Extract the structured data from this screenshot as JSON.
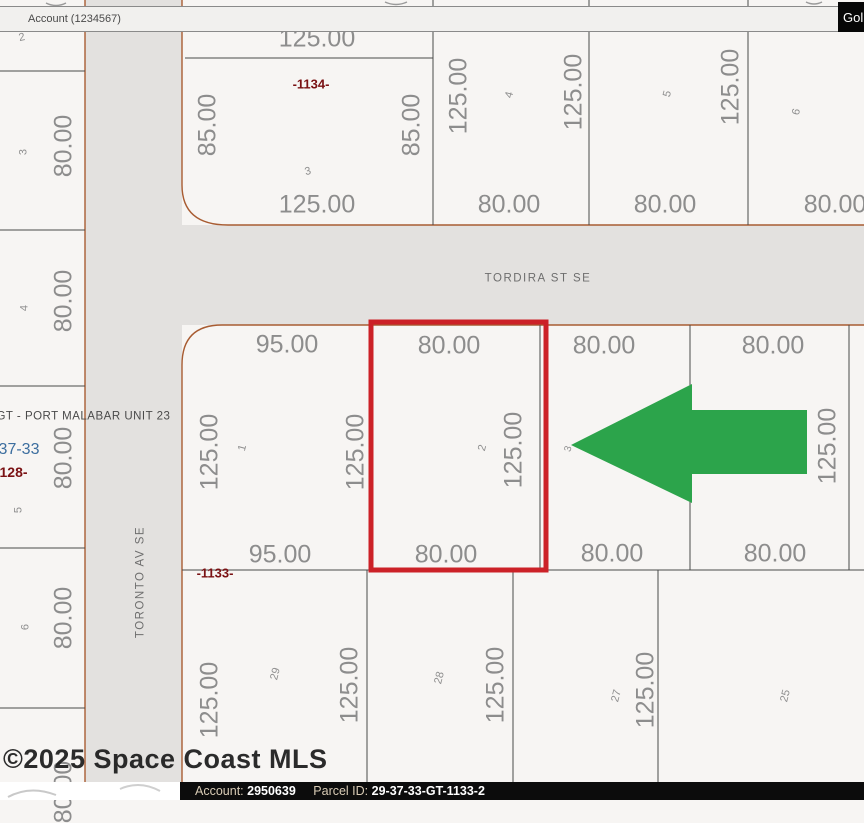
{
  "top_bar": {
    "account_label": "Account (1234567)",
    "go_button_label": "Gol"
  },
  "bottom_bar": {
    "account_label": "Account:",
    "account_value": "2950639",
    "parcel_label": "Parcel ID:",
    "parcel_value": "29-37-33-GT-1133-2"
  },
  "watermark": "©2025 Space Coast MLS",
  "colors": {
    "red_highlight": "#cc2127",
    "arrow_green": "#2ca44b",
    "road_gray": "#e3e1df",
    "parcel_fill": "#f7f5f3",
    "boundary_brown": "#a85c32",
    "line_dark": "#4a4a4a"
  },
  "map": {
    "labels": [
      {
        "text": "TORDIRA ST SE",
        "x": 538,
        "y": 279,
        "rot": 0,
        "cls": "street",
        "name": "street-name-tordira"
      },
      {
        "text": "TORONTO AV SE",
        "x": 141,
        "y": 582,
        "rot": -90,
        "cls": "street",
        "name": "street-name-toronto"
      },
      {
        "text": "-1134-",
        "x": 311,
        "y": 84,
        "rot": 0,
        "cls": "blockref",
        "name": "block-number-1134"
      },
      {
        "text": "-1133-",
        "x": 215,
        "y": 573,
        "rot": 0,
        "cls": "blockref",
        "name": "block-number-1133"
      },
      {
        "text": "#GT - PORT MALABAR UNIT 23",
        "x": 80,
        "y": 417,
        "rot": 0,
        "cls": "unitref",
        "name": "plat-unit-label"
      },
      {
        "text": "37-33",
        "x": 19,
        "y": 450,
        "rot": 0,
        "cls": "blueref",
        "name": "township-range-label"
      },
      {
        "text": "1128-",
        "x": 10,
        "y": 472,
        "rot": 0,
        "cls": "redref",
        "name": "block-number-1128"
      },
      {
        "text": "80.00",
        "x": 64,
        "y": 146,
        "rot": -90,
        "cls": "dim",
        "name": "dimension-label"
      },
      {
        "text": "80.00",
        "x": 64,
        "y": 301,
        "rot": -90,
        "cls": "dim",
        "name": "dimension-label"
      },
      {
        "text": "80.00",
        "x": 64,
        "y": 458,
        "rot": -90,
        "cls": "dim",
        "name": "dimension-label"
      },
      {
        "text": "80.00",
        "x": 64,
        "y": 618,
        "rot": -90,
        "cls": "dim",
        "name": "dimension-label"
      },
      {
        "text": "80.00",
        "x": 64,
        "y": 792,
        "rot": -90,
        "cls": "dim",
        "name": "dimension-label"
      },
      {
        "text": "125.00",
        "x": 317,
        "y": 39,
        "rot": 0,
        "cls": "dim",
        "name": "dimension-label"
      },
      {
        "text": "85.00",
        "x": 208,
        "y": 125,
        "rot": -90,
        "cls": "dim",
        "name": "dimension-label"
      },
      {
        "text": "85.00",
        "x": 412,
        "y": 125,
        "rot": -90,
        "cls": "dim",
        "name": "dimension-label"
      },
      {
        "text": "125.00",
        "x": 317,
        "y": 205,
        "rot": 0,
        "cls": "dim",
        "name": "dimension-label"
      },
      {
        "text": "125.00",
        "x": 459,
        "y": 96,
        "rot": -90,
        "cls": "dim",
        "name": "dimension-label"
      },
      {
        "text": "125.00",
        "x": 574,
        "y": 92,
        "rot": -90,
        "cls": "dim",
        "name": "dimension-label"
      },
      {
        "text": "80.00",
        "x": 509,
        "y": 205,
        "rot": 0,
        "cls": "dim",
        "name": "dimension-label"
      },
      {
        "text": "125.00",
        "x": 731,
        "y": 87,
        "rot": -90,
        "cls": "dim",
        "name": "dimension-label"
      },
      {
        "text": "80.00",
        "x": 665,
        "y": 205,
        "rot": 0,
        "cls": "dim",
        "name": "dimension-label"
      },
      {
        "text": "80.00",
        "x": 835,
        "y": 205,
        "rot": 0,
        "cls": "dim",
        "name": "dimension-label"
      },
      {
        "text": "95.00",
        "x": 287,
        "y": 345,
        "rot": 0,
        "cls": "dim",
        "name": "dimension-label"
      },
      {
        "text": "125.00",
        "x": 210,
        "y": 452,
        "rot": -90,
        "cls": "dim",
        "name": "dimension-label"
      },
      {
        "text": "125.00",
        "x": 356,
        "y": 452,
        "rot": -90,
        "cls": "dim",
        "name": "dimension-label"
      },
      {
        "text": "95.00",
        "x": 280,
        "y": 555,
        "rot": 0,
        "cls": "dim",
        "name": "dimension-label"
      },
      {
        "text": "80.00",
        "x": 449,
        "y": 346,
        "rot": 0,
        "cls": "dim",
        "name": "dimension-label"
      },
      {
        "text": "125.00",
        "x": 514,
        "y": 450,
        "rot": -90,
        "cls": "dim",
        "name": "dimension-label"
      },
      {
        "text": "80.00",
        "x": 446,
        "y": 555,
        "rot": 0,
        "cls": "dim",
        "name": "dimension-label"
      },
      {
        "text": "80.00",
        "x": 604,
        "y": 346,
        "rot": 0,
        "cls": "dim",
        "name": "dimension-label"
      },
      {
        "text": "80.00",
        "x": 612,
        "y": 554,
        "rot": 0,
        "cls": "dim",
        "name": "dimension-label"
      },
      {
        "text": "80.00",
        "x": 773,
        "y": 346,
        "rot": 0,
        "cls": "dim",
        "name": "dimension-label"
      },
      {
        "text": "125.00",
        "x": 828,
        "y": 446,
        "rot": -90,
        "cls": "dim",
        "name": "dimension-label"
      },
      {
        "text": "80.00",
        "x": 775,
        "y": 554,
        "rot": 0,
        "cls": "dim",
        "name": "dimension-label"
      },
      {
        "text": "125.00",
        "x": 210,
        "y": 700,
        "rot": -90,
        "cls": "dim",
        "name": "dimension-label"
      },
      {
        "text": "125.00",
        "x": 350,
        "y": 685,
        "rot": -90,
        "cls": "dim",
        "name": "dimension-label"
      },
      {
        "text": "125.00",
        "x": 496,
        "y": 685,
        "rot": -90,
        "cls": "dim",
        "name": "dimension-label"
      },
      {
        "text": "125.00",
        "x": 646,
        "y": 690,
        "rot": -90,
        "cls": "dim",
        "name": "dimension-label"
      },
      {
        "text": "2",
        "x": 22,
        "y": 38,
        "rot": -12,
        "cls": "lotnum",
        "name": "lot-number"
      },
      {
        "text": "3",
        "x": 24,
        "y": 152,
        "rot": -90,
        "cls": "lotnum",
        "name": "lot-number"
      },
      {
        "text": "4",
        "x": 25,
        "y": 308,
        "rot": -90,
        "cls": "lotnum",
        "name": "lot-number"
      },
      {
        "text": "5",
        "x": 19,
        "y": 510,
        "rot": -90,
        "cls": "lotnum",
        "name": "lot-number"
      },
      {
        "text": "6",
        "x": 26,
        "y": 627,
        "rot": -90,
        "cls": "lotnum",
        "name": "lot-number"
      },
      {
        "text": "3",
        "x": 308,
        "y": 172,
        "rot": -15,
        "cls": "lotnum",
        "name": "lot-number"
      },
      {
        "text": "4",
        "x": 510,
        "y": 95,
        "rot": -75,
        "cls": "lotnum",
        "name": "lot-number"
      },
      {
        "text": "5",
        "x": 668,
        "y": 94,
        "rot": -75,
        "cls": "lotnum",
        "name": "lot-number"
      },
      {
        "text": "6",
        "x": 797,
        "y": 112,
        "rot": -75,
        "cls": "lotnum",
        "name": "lot-number"
      },
      {
        "text": "1",
        "x": 243,
        "y": 448,
        "rot": -75,
        "cls": "lotnum",
        "name": "lot-number"
      },
      {
        "text": "2",
        "x": 483,
        "y": 448,
        "rot": -75,
        "cls": "lotnum",
        "name": "lot-number"
      },
      {
        "text": "3",
        "x": 569,
        "y": 449,
        "rot": -75,
        "cls": "lotnum tiny",
        "name": "lot-number"
      },
      {
        "text": "29",
        "x": 276,
        "y": 674,
        "rot": -75,
        "cls": "lotnum",
        "name": "lot-number"
      },
      {
        "text": "28",
        "x": 440,
        "y": 678,
        "rot": -75,
        "cls": "lotnum",
        "name": "lot-number"
      },
      {
        "text": "27",
        "x": 617,
        "y": 696,
        "rot": -75,
        "cls": "lotnum",
        "name": "lot-number"
      },
      {
        "text": "25",
        "x": 786,
        "y": 696,
        "rot": -75,
        "cls": "lotnum",
        "name": "lot-number"
      }
    ]
  }
}
